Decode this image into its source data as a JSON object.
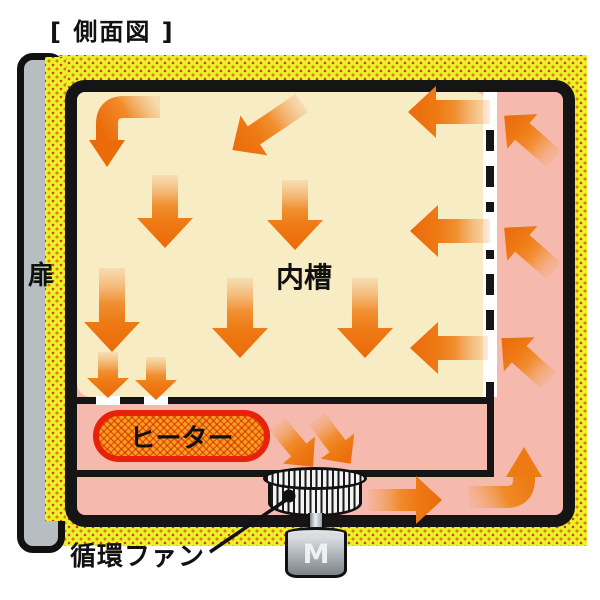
{
  "title": "[ 側面図 ]",
  "diagram": {
    "door_label": "扉",
    "chamber_label": "内槽",
    "heater_label": "ヒーター",
    "fan_label": "循環ファン",
    "motor_label": "M"
  },
  "icons": {
    "airflow_arrow": "orange gradient arrow indicating circulating air",
    "fan_drum": "striped cross-flow fan drum",
    "leader_line": "pointer line from fan to its label"
  },
  "colors": {
    "insulation_yellow": "#ecf22a",
    "insulation_dots": "#e07a10",
    "chamber_cream": "#f8ecc4",
    "plenum_pink": "#f6b9ae",
    "arrow_orange": "#ec6c0c",
    "heater_fill": "#f7a01e",
    "heater_border": "#e8210a",
    "door_gray": "#b7bdc1",
    "outline_black": "#151515"
  }
}
